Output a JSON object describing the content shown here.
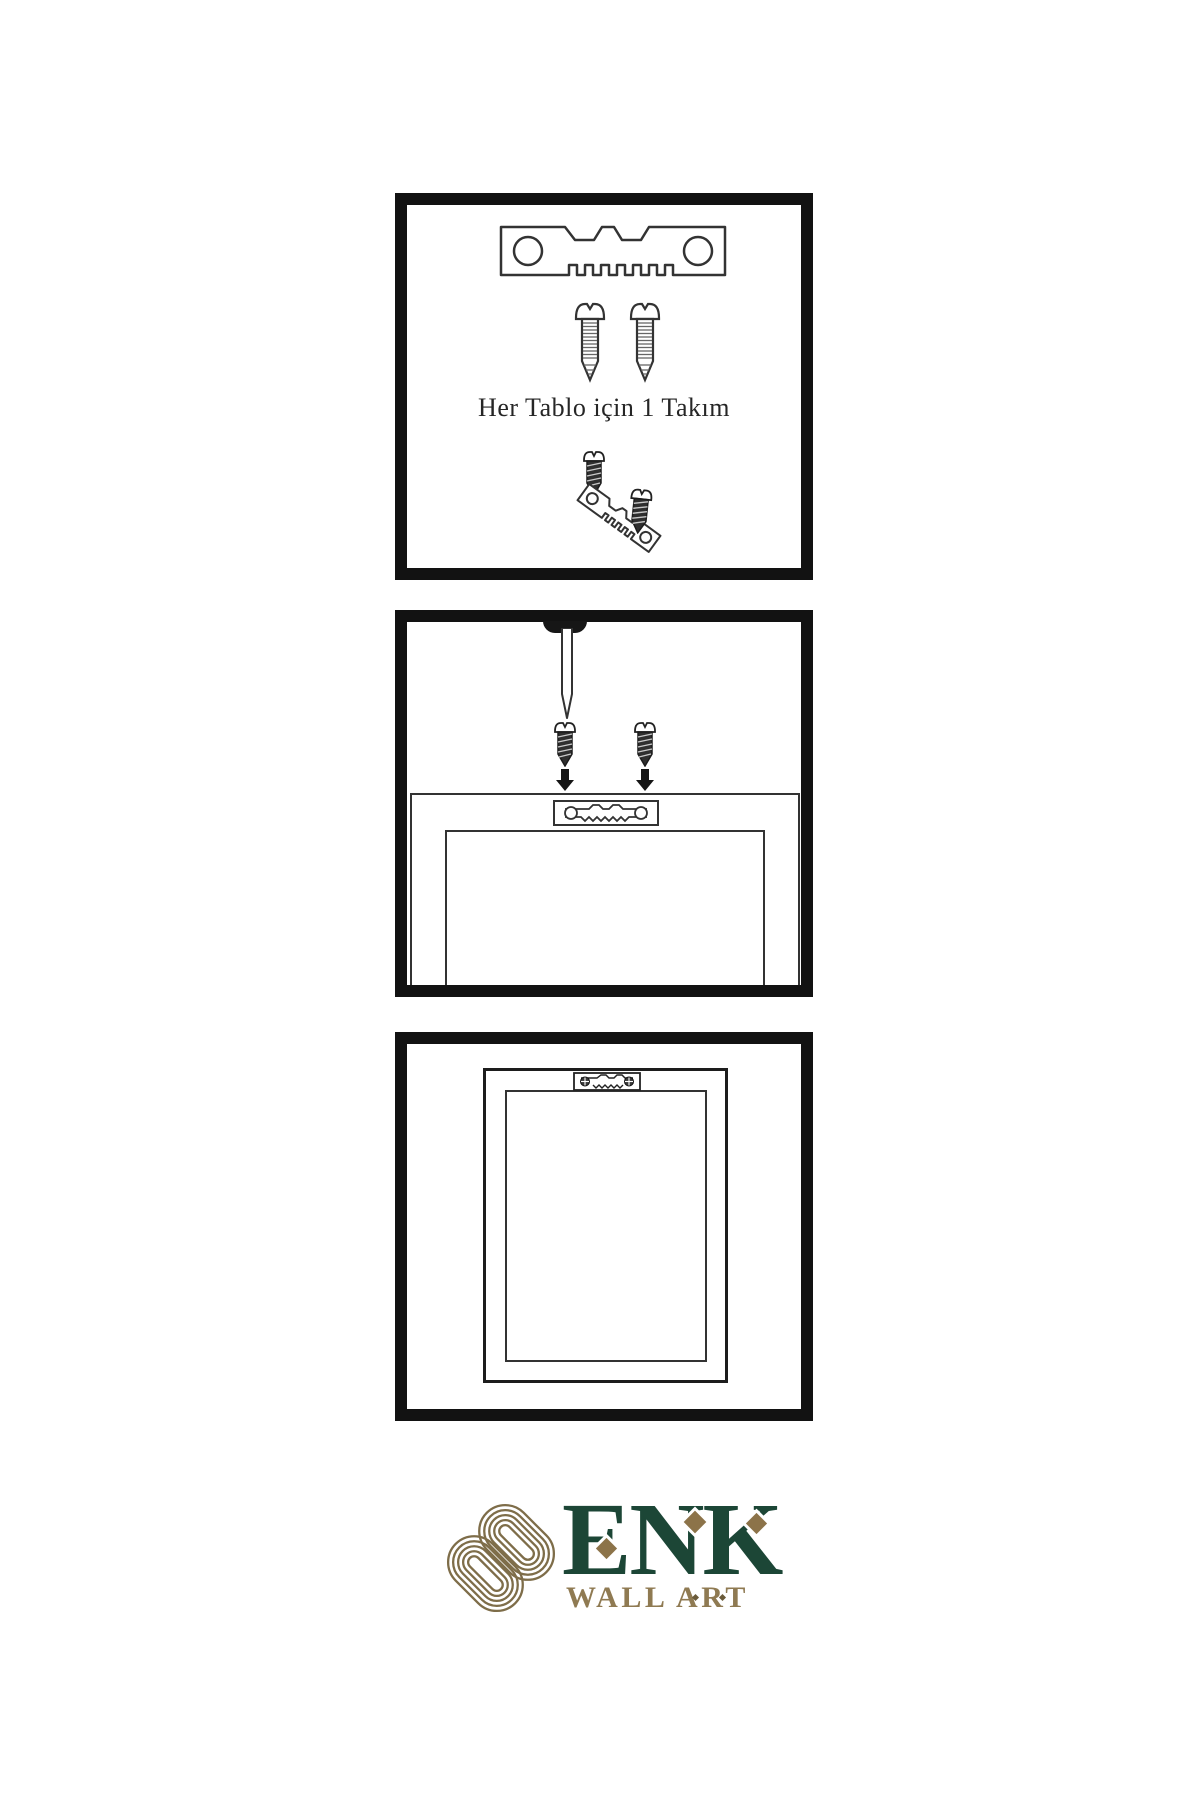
{
  "document": {
    "type": "wall-art hanging instruction sheet",
    "background": "#ffffff"
  },
  "steps": {
    "panel1": {
      "caption": "Her Tablo için 1 Takım",
      "contents": [
        "sawtooth-hanger",
        "screw",
        "screw",
        "screw-into-tilted-hanger"
      ]
    },
    "panel2": {
      "contents": [
        "wall-nail",
        "two-screws-with-down-arrows",
        "frame-back-with-sawtooth-hanger"
      ]
    },
    "panel3": {
      "contents": [
        "hung-frame-front-with-sawtooth-hanger"
      ]
    }
  },
  "brand": {
    "name": "ENK",
    "tagline": "WALL ART",
    "green": "#1c4636",
    "gold": "#8c7349",
    "knot_gold": "#7e6d49",
    "tagline_gold": "#8f7a52"
  },
  "colors": {
    "panel_border": "#121212",
    "line_art": "#333333",
    "dark_hardware": "#2f2f2f"
  },
  "icons": {
    "sawtooth-hanger-icon": "toothed metal plate with two holes",
    "screw-icon": "outlined threaded screw",
    "dark-screw-icon": "dark threaded screw",
    "wall-nail-icon": "nail driven into wall from top",
    "down-arrow-icon": "solid downward arrow",
    "knot-icon": "interlaced gold knot monogram",
    "diamond-accent": "gold rotated square"
  }
}
